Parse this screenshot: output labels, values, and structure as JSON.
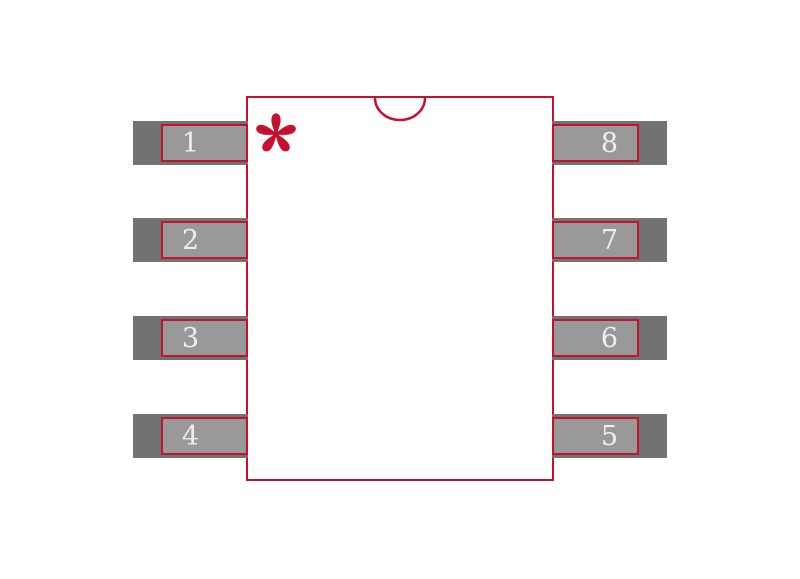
{
  "footprint": {
    "description": "8-pin IC package footprint diagram",
    "colors": {
      "outline_red": "#C4112E",
      "lead_fill": "#727272",
      "pad_fill": "#999999",
      "pin_number_text": "#EFEFEF",
      "background": "#FFFFFF"
    },
    "pin1_marker": {
      "icon": "asterisk",
      "color": "#C4112E"
    },
    "notch": {
      "shape": "semicircle",
      "position": "top-center"
    },
    "pins": [
      {
        "number": "1",
        "side": "left",
        "row": 1
      },
      {
        "number": "2",
        "side": "left",
        "row": 2
      },
      {
        "number": "3",
        "side": "left",
        "row": 3
      },
      {
        "number": "4",
        "side": "left",
        "row": 4
      },
      {
        "number": "8",
        "side": "right",
        "row": 1
      },
      {
        "number": "7",
        "side": "right",
        "row": 2
      },
      {
        "number": "6",
        "side": "right",
        "row": 3
      },
      {
        "number": "5",
        "side": "right",
        "row": 4
      }
    ]
  }
}
